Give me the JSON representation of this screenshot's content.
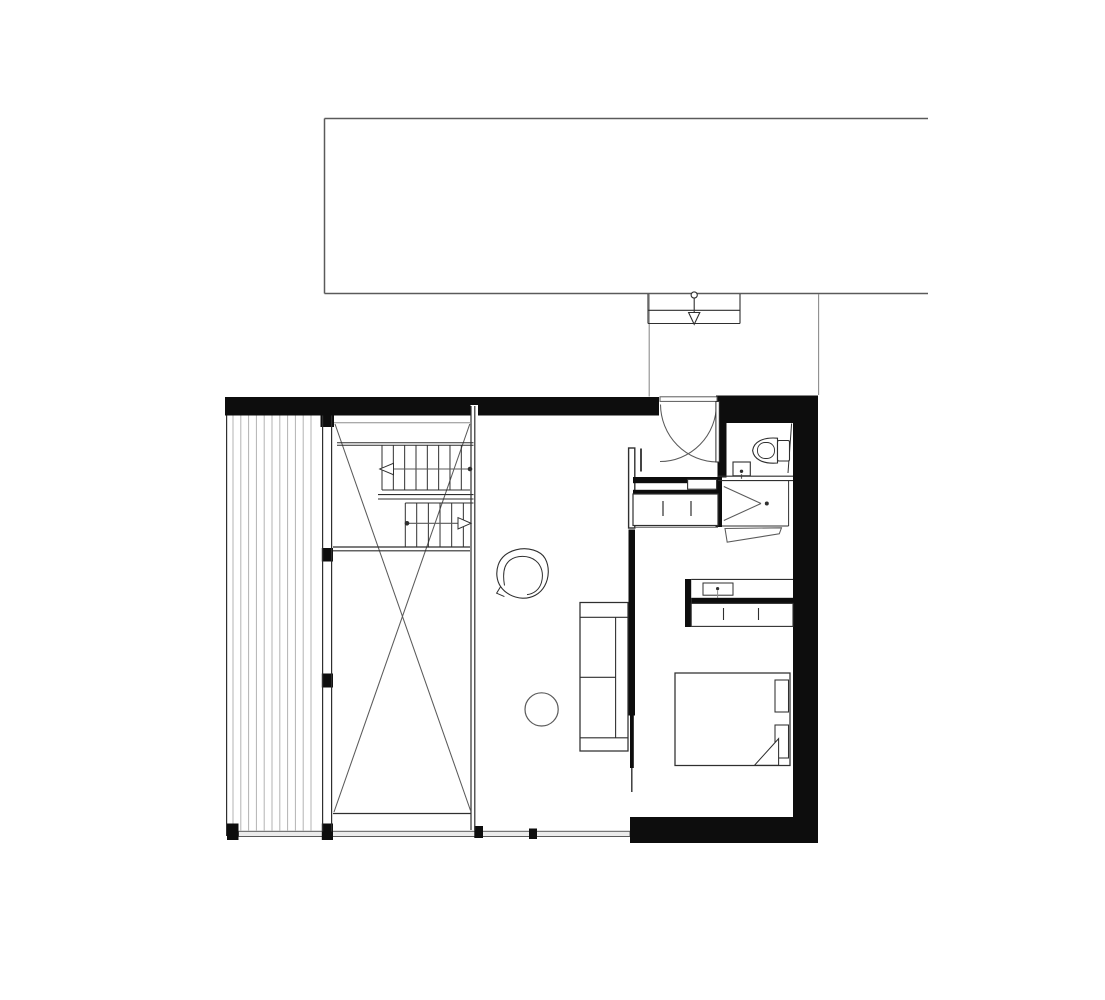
{
  "drawing": {
    "type": "architectural-floor-plan",
    "visible_text_labels": [],
    "icons": {
      "entrance_arrow": "open-triangle-down-arrow",
      "stair_upper_run_arrow": "open-triangle-left-arrow",
      "stair_lower_run_arrow": "open-triangle-right-arrow",
      "shower_drain": "dot",
      "basin_tap": "dot"
    }
  },
  "colors": {
    "background": "#ffffff",
    "wall": "#0d0d0d",
    "line_dark": "#2f2f2f",
    "line_mid": "#5a5a5a",
    "line_light": "#8d8d8d",
    "hatch": "#b3b3b3",
    "sill_fill": "#ececec"
  },
  "patterns": {
    "deck_hatch": {
      "x_start": 233,
      "x_end": 318,
      "spacing": 7.8,
      "y_top": 415.5,
      "y_bottom": 830.5
    },
    "stair_upper_treads": {
      "x_start": 382,
      "x_end": 461.5,
      "spacing": 11.33,
      "y_top": 445.2,
      "y_bottom": 490
    },
    "stair_lower_treads": {
      "x_start": 416.7,
      "x_end": 463.5,
      "spacing": 11.66,
      "y_top": 503,
      "y_bottom": 546.5
    }
  }
}
